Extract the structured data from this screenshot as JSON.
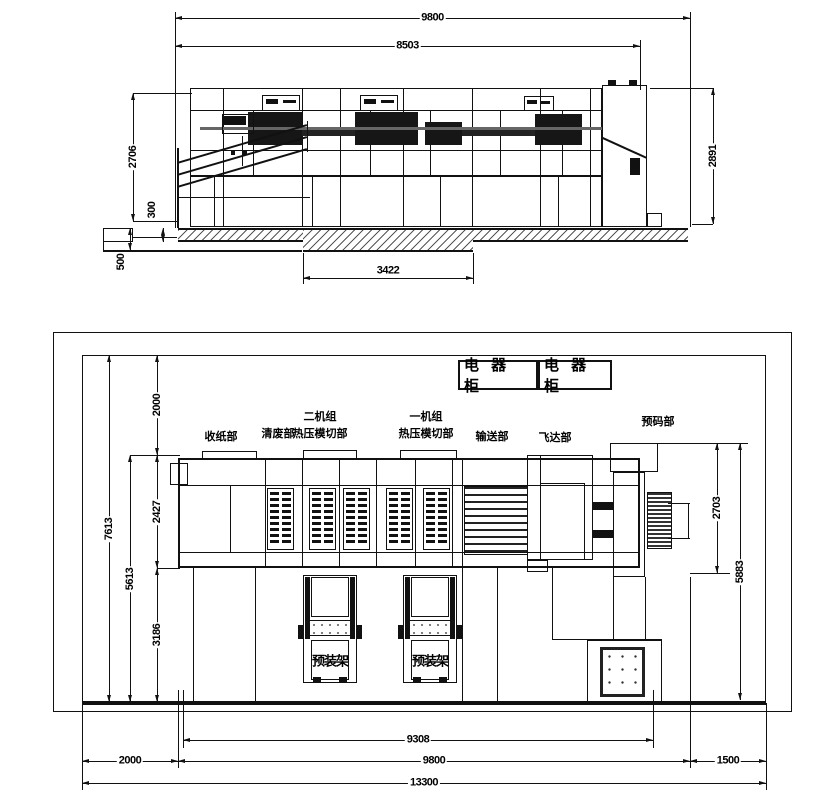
{
  "drawing": {
    "top_view": {
      "dims": {
        "overall_width": "9800",
        "body_width": "8503",
        "body_height": "2706",
        "feeder_height": "2891",
        "slab_step": "300",
        "pit_depth": "500",
        "pit_width": "3422"
      }
    },
    "plan_view": {
      "cabinets": [
        {
          "label": "电 器 柜"
        },
        {
          "label": "电 器 柜"
        }
      ],
      "sections": [
        {
          "line1": "收纸部",
          "line2": ""
        },
        {
          "line1": "清废部",
          "line2": ""
        },
        {
          "line1": "二机组",
          "line2": "热压模切部"
        },
        {
          "line1": "一机组",
          "line2": "热压模切部"
        },
        {
          "line1": "输送部",
          "line2": ""
        },
        {
          "line1": "飞达部",
          "line2": ""
        },
        {
          "line1": "预码部",
          "line2": ""
        }
      ],
      "racks": [
        {
          "label": "预装架"
        },
        {
          "label": "预装架"
        }
      ],
      "dims": {
        "site_height": "7613",
        "inner_height": "5613",
        "top_margin": "2000",
        "machine_depth": "2427",
        "bottom_margin": "3186",
        "stacker_depth": "2703",
        "right_span": "5883",
        "machine_length": "9308",
        "room_width": "9800",
        "left_margin": "2000",
        "right_margin": "1500",
        "total_width": "13300"
      }
    }
  }
}
